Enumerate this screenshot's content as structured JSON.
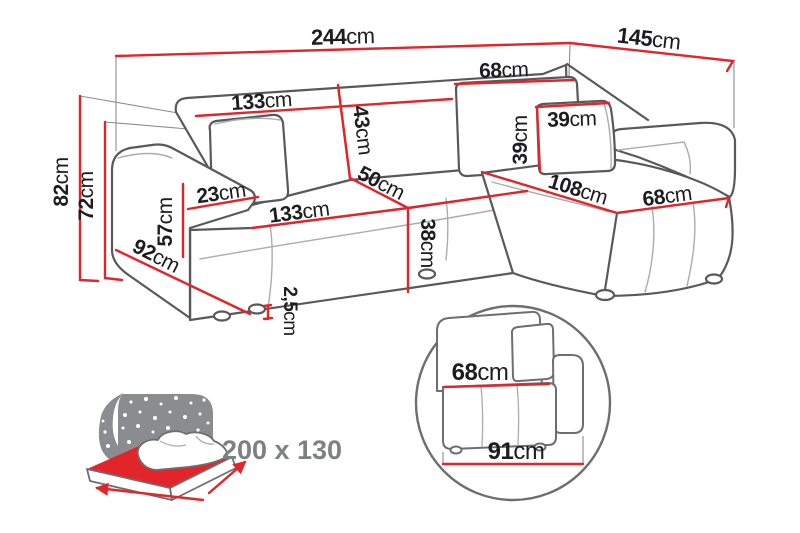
{
  "meta": {
    "type": "product dimension diagram",
    "subject": "corner sofa bed with chaise"
  },
  "colors": {
    "dimension_red": "#e2242b",
    "outline_gray": "#58595b",
    "seam_gray": "#aaacae",
    "icon_gray": "#8a8c8f",
    "label_black": "#1d1d1f",
    "label_gray": "#7e8083",
    "background": "#ffffff"
  },
  "dims": {
    "total_width": {
      "value": "244",
      "unit": "cm"
    },
    "total_depth": {
      "value": "145",
      "unit": "cm"
    },
    "total_height": {
      "value": "82",
      "unit": "cm"
    },
    "back_height": {
      "value": "72",
      "unit": "cm"
    },
    "back_cushion_width": {
      "value": "133",
      "unit": "cm"
    },
    "back_cushion_height": {
      "value": "43",
      "unit": "cm"
    },
    "corner_seam": {
      "value": "50",
      "unit": "cm"
    },
    "right_back_cushion": {
      "value": "68",
      "unit": "cm"
    },
    "pillow_height": {
      "value": "39",
      "unit": "cm"
    },
    "pillow_width": {
      "value": "39",
      "unit": "cm"
    },
    "armrest_width": {
      "value": "23",
      "unit": "cm"
    },
    "armrest_height": {
      "value": "57",
      "unit": "cm"
    },
    "side_depth": {
      "value": "92",
      "unit": "cm"
    },
    "seat_width": {
      "value": "133",
      "unit": "cm"
    },
    "seat_height": {
      "value": "38",
      "unit": "cm"
    },
    "chaise_length": {
      "value": "108",
      "unit": "cm"
    },
    "chaise_width": {
      "value": "68",
      "unit": "cm"
    },
    "leg_height": {
      "value": "2,5",
      "unit": "cm"
    }
  },
  "sleeping_area": {
    "size": "200 x 130"
  },
  "detail": {
    "seat_width": {
      "value": "68",
      "unit": "cm"
    },
    "total_width": {
      "value": "91",
      "unit": "cm"
    }
  }
}
